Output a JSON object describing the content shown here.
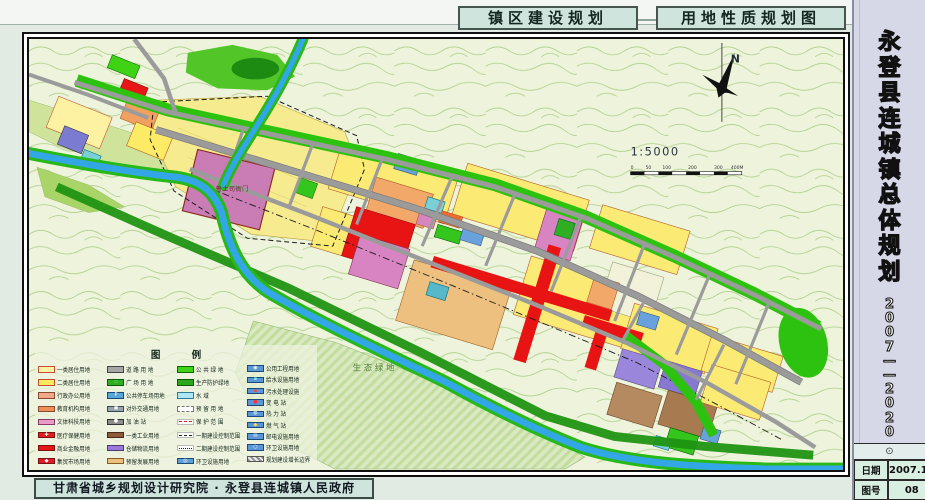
{
  "header": {
    "title_left": "镇区建设规划",
    "title_right": "用地性质规划图"
  },
  "sidebar": {
    "title": "永登县连城镇总体规划",
    "period": "2007——2020",
    "stamp": "⊙",
    "info": [
      {
        "label": "日期",
        "value": "2007.11"
      },
      {
        "label": "图号",
        "value": "08"
      }
    ]
  },
  "footer": {
    "credit": "甘肃省城乡规划设计研究院 · 永登县连城镇人民政府"
  },
  "map": {
    "north_label": "N",
    "scale_label": "1:5000",
    "scale_ticks": [
      "0",
      "50",
      "100",
      "200",
      "300",
      "400M"
    ],
    "labels": {
      "yamen": "鲁土司衙门",
      "eco_green": "生 态 绿 地"
    },
    "legend": {
      "title": "图    例",
      "columns": [
        [
          {
            "label": "一类居住用地",
            "swatch": {
              "type": "solid",
              "color": "#fdf3a6",
              "border": "#c05030"
            }
          },
          {
            "label": "二类居住用地",
            "swatch": {
              "type": "solid",
              "color": "#fde95e",
              "border": "#c05030"
            }
          },
          {
            "label": "行政办公用地",
            "swatch": {
              "type": "solid",
              "color": "#f2a98a",
              "border": "#8a4a30"
            }
          },
          {
            "label": "教育机构用地",
            "swatch": {
              "type": "solid",
              "color": "#ef8f55",
              "border": "#8a4a30"
            }
          },
          {
            "label": "文体科技用地",
            "swatch": {
              "type": "solid",
              "color": "#ea9cc6",
              "border": "#8a3a6a"
            }
          },
          {
            "label": "医疗保健用地",
            "swatch": {
              "type": "icon",
              "color": "#e41b1b",
              "border": "#7a1010",
              "glyph": "✚",
              "glyph_color": "#ffffff"
            }
          },
          {
            "label": "商业金融用地",
            "swatch": {
              "type": "solid",
              "color": "#e61515",
              "border": "#7a1010"
            }
          },
          {
            "label": "集贸市场用地",
            "swatch": {
              "type": "icon",
              "color": "#df1a28",
              "border": "#7a1010",
              "glyph": "◆",
              "glyph_color": "#ffffff"
            }
          }
        ],
        [
          {
            "label": "道 路 用 地",
            "swatch": {
              "type": "solid",
              "color": "#a6a6a6",
              "border": "#444444"
            }
          },
          {
            "label": "广 场 用 地",
            "swatch": {
              "type": "icon",
              "color": "#2fae23",
              "border": "#0a5a08",
              "glyph": "∷",
              "glyph_color": "#ffffff"
            }
          },
          {
            "label": "公共停车场用地",
            "swatch": {
              "type": "icon",
              "color": "#59a7d7",
              "border": "#1a4a7a",
              "glyph": "P",
              "glyph_color": "#ffffff"
            }
          },
          {
            "label": "对外交通用地",
            "swatch": {
              "type": "icon",
              "color": "#98a2ac",
              "border": "#3a4a55",
              "glyph": "▣",
              "glyph_color": "#ffffff"
            }
          },
          {
            "label": "加 油 站",
            "swatch": {
              "type": "icon",
              "color": "#8d8d8d",
              "border": "#333333",
              "glyph": "●",
              "glyph_color": "#ffffff"
            }
          },
          {
            "label": "一类工业用地",
            "swatch": {
              "type": "solid",
              "color": "#8d5a3b",
              "border": "#4a2a18"
            }
          },
          {
            "label": "仓储物流用地",
            "swatch": {
              "type": "solid",
              "color": "#9a79d8",
              "border": "#4a3a7a"
            }
          },
          {
            "label": "预留发展用地",
            "swatch": {
              "type": "solid",
              "color": "#eec07f",
              "border": "#8a5a20"
            }
          }
        ],
        [
          {
            "label": "公 共 绿 地",
            "swatch": {
              "type": "solid",
              "color": "#3fd215",
              "border": "#0a6a08"
            }
          },
          {
            "label": "生产防护绿地",
            "swatch": {
              "type": "solid",
              "color": "#2aa81a",
              "border": "#0a5a08"
            }
          },
          {
            "label": "水    域",
            "swatch": {
              "type": "solid",
              "color": "#aee6f2",
              "border": "#2a7a9a"
            }
          },
          {
            "label": "预 留 用 地",
            "swatch": {
              "type": "outline-dashed",
              "color": "#ffffff",
              "border": "#777777"
            }
          },
          {
            "label": "保 护 范 围",
            "swatch": {
              "type": "line-dash",
              "line_color": "#e02020"
            }
          },
          {
            "label": "一期建设控制范围",
            "swatch": {
              "type": "line-dash",
              "line_color": "#222222"
            }
          },
          {
            "label": "二期建设控制范围",
            "swatch": {
              "type": "line-dashdot",
              "line_color": "#222222"
            }
          },
          {
            "label": "环卫设施用地",
            "swatch": {
              "type": "icon",
              "color": "#5f9fd8",
              "border": "#1a4a7a",
              "glyph": "◎",
              "glyph_color": "#ffffff"
            }
          }
        ],
        [
          {
            "label": "公用工程用地",
            "swatch": {
              "type": "icon",
              "color": "#5b97d6",
              "border": "#1a4a7a",
              "glyph": "◉",
              "glyph_color": "#ffffff"
            }
          },
          {
            "label": "给水设施用地",
            "swatch": {
              "type": "icon",
              "color": "#5b97d6",
              "border": "#1a4a7a",
              "glyph": "▪",
              "glyph_color": "#7ff0f0"
            }
          },
          {
            "label": "污水处理设施",
            "swatch": {
              "type": "icon",
              "color": "#5b97d6",
              "border": "#1a4a7a",
              "glyph": "▪",
              "glyph_color": "#ff4040"
            }
          },
          {
            "label": "变 电 站",
            "swatch": {
              "type": "icon",
              "color": "#5b97d6",
              "border": "#1a4a7a",
              "glyph": "●",
              "glyph_color": "#ff3030"
            }
          },
          {
            "label": "热 力 站",
            "swatch": {
              "type": "icon",
              "color": "#5b97d6",
              "border": "#1a4a7a",
              "glyph": "◍",
              "glyph_color": "#ffffff"
            }
          },
          {
            "label": "燃 气 站",
            "swatch": {
              "type": "icon",
              "color": "#5b97d6",
              "border": "#1a4a7a",
              "glyph": "◆",
              "glyph_color": "#ffe040"
            }
          },
          {
            "label": "邮电设施用地",
            "swatch": {
              "type": "icon",
              "color": "#5b97d6",
              "border": "#1a4a7a",
              "glyph": "✉",
              "glyph_color": "#ffffff"
            }
          },
          {
            "label": "环卫设施用地",
            "swatch": {
              "type": "icon",
              "color": "#5b97d6",
              "border": "#1a4a7a",
              "glyph": "○",
              "glyph_color": "#ffffff"
            }
          },
          {
            "label": "规划建设增长边界",
            "swatch": {
              "type": "hatch"
            }
          }
        ]
      ]
    }
  },
  "colors": {
    "vegetation_green": "#2ec210",
    "river_blue": "#33a6e6",
    "road_gray": "#9b9b9b",
    "sidebar_lavender": "#d6d8e8",
    "panel_green": "#cfe4dd"
  }
}
